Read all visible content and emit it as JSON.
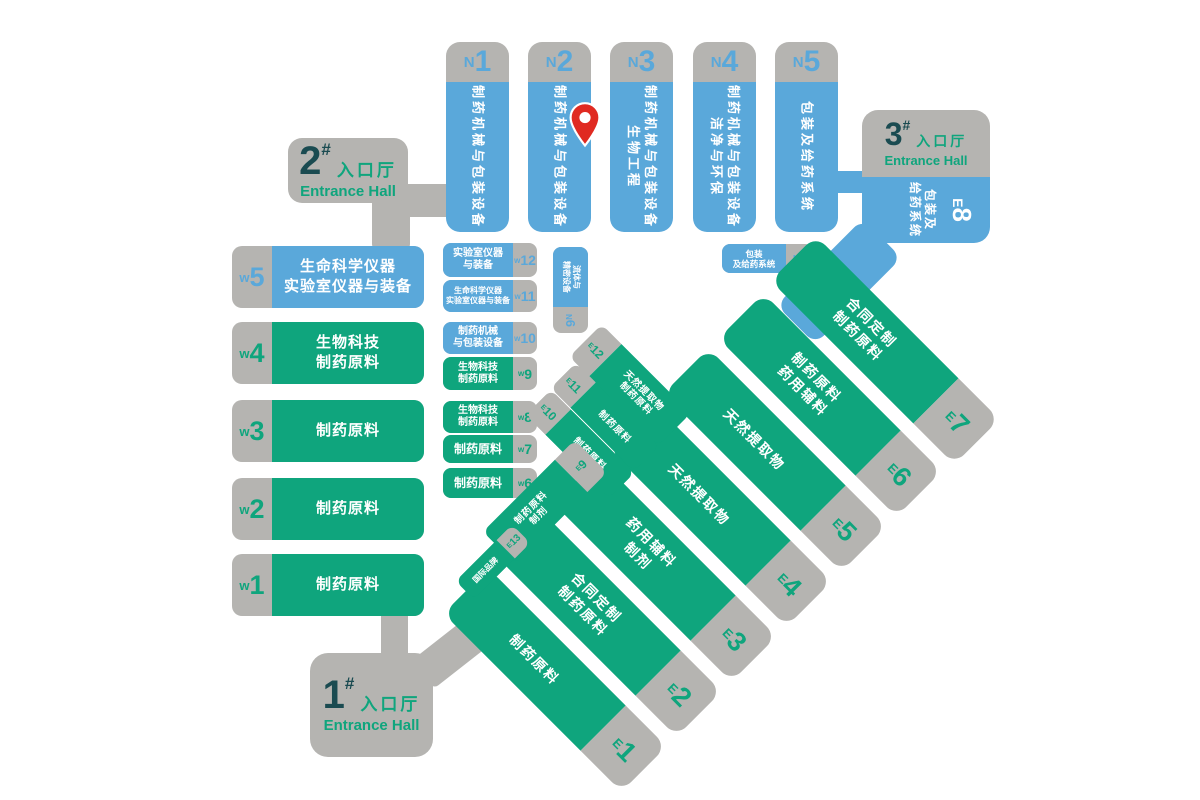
{
  "colors": {
    "hall_blue": "#5aa8da",
    "hall_green": "#0fa57d",
    "label_gray": "#b5b4b1",
    "entrance_number_dark": "#1a4b51",
    "entrance_text_green": "#0fa57d",
    "pin_red": "#e02a21"
  },
  "halls": {
    "north": [
      {
        "prefix": "N",
        "num": "1",
        "lines": [
          "制药机械与包装设备"
        ]
      },
      {
        "prefix": "N",
        "num": "2",
        "lines": [
          "制药机械与包装设备"
        ]
      },
      {
        "prefix": "N",
        "num": "3",
        "lines": [
          "制药机械与包装设备",
          "生物工程"
        ]
      },
      {
        "prefix": "N",
        "num": "4",
        "lines": [
          "制药机械与包装设备",
          "洁净与环保"
        ]
      },
      {
        "prefix": "N",
        "num": "5",
        "lines": [
          "包装及给药系统"
        ]
      }
    ],
    "west_main": [
      {
        "prefix": "w",
        "num": "5",
        "lines": [
          "生命科学仪器",
          "实验室仪器与装备"
        ]
      },
      {
        "prefix": "w",
        "num": "4",
        "lines": [
          "生物科技",
          "制药原料"
        ]
      },
      {
        "prefix": "w",
        "num": "3",
        "lines": [
          "制药原料"
        ]
      },
      {
        "prefix": "w",
        "num": "2",
        "lines": [
          "制药原料"
        ]
      },
      {
        "prefix": "w",
        "num": "1",
        "lines": [
          "制药原料"
        ]
      }
    ],
    "west_small": [
      {
        "prefix": "w",
        "num": "12",
        "lines": [
          "实验室仪器",
          "与装备"
        ]
      },
      {
        "prefix": "w",
        "num": "11",
        "lines": [
          "生命科学仪器",
          "实验室仪器与装备"
        ]
      },
      {
        "prefix": "w",
        "num": "10",
        "lines": [
          "制药机械",
          "与包装设备"
        ]
      },
      {
        "prefix": "w",
        "num": "9",
        "lines": [
          "生物科技",
          "制药原料"
        ]
      },
      {
        "prefix": "w",
        "num": "8",
        "lines": [
          "生物科技",
          "制药原料"
        ]
      },
      {
        "prefix": "w",
        "num": "7",
        "lines": [
          "制药原料"
        ]
      },
      {
        "prefix": "w",
        "num": "6",
        "lines": [
          "制药原料"
        ]
      }
    ],
    "east_main": [
      {
        "prefix": "E",
        "num": "7",
        "lines": [
          "合同定制",
          "制药原料"
        ]
      },
      {
        "prefix": "E",
        "num": "6",
        "lines": [
          "制药原料",
          "药用辅料"
        ]
      },
      {
        "prefix": "E",
        "num": "5",
        "lines": [
          "天然提取物"
        ]
      },
      {
        "prefix": "E",
        "num": "4",
        "lines": [
          "天然提取物"
        ]
      },
      {
        "prefix": "E",
        "num": "3",
        "lines": [
          "药用辅料",
          "制剂"
        ]
      },
      {
        "prefix": "E",
        "num": "2",
        "lines": [
          "合同定制",
          "制药原料"
        ]
      },
      {
        "prefix": "E",
        "num": "1",
        "lines": [
          "制药原料"
        ]
      }
    ],
    "east_small": [
      {
        "prefix": "E",
        "num": "12",
        "lines": [
          "天然提取物",
          "制药原料"
        ]
      },
      {
        "prefix": "E",
        "num": "11",
        "lines": [
          "制药原料"
        ]
      },
      {
        "prefix": "E",
        "num": "10",
        "lines": [
          "制药原料"
        ]
      },
      {
        "prefix": "E",
        "num": "9",
        "lines": [
          "制药原料",
          "制剂"
        ]
      },
      {
        "prefix": "E",
        "num": "13",
        "lines": [
          "国际品牌"
        ]
      }
    ],
    "n6": {
      "prefix": "N",
      "num": "6",
      "lines": [
        "流体与",
        "精密设备"
      ]
    },
    "n7": {
      "prefix": "N",
      "num": "7",
      "lines": [
        "包装",
        "及给药系统"
      ]
    },
    "e8": {
      "prefix": "E",
      "num": "8",
      "lines": [
        "包装及",
        "给药系统"
      ]
    }
  },
  "entrances": [
    {
      "num": "1",
      "hash": "#",
      "zh": "入口厅",
      "en": "Entrance Hall"
    },
    {
      "num": "2",
      "hash": "#",
      "zh": "入口厅",
      "en": "Entrance Hall"
    },
    {
      "num": "3",
      "hash": "#",
      "zh": "入口厅",
      "en": "Entrance Hall"
    }
  ]
}
